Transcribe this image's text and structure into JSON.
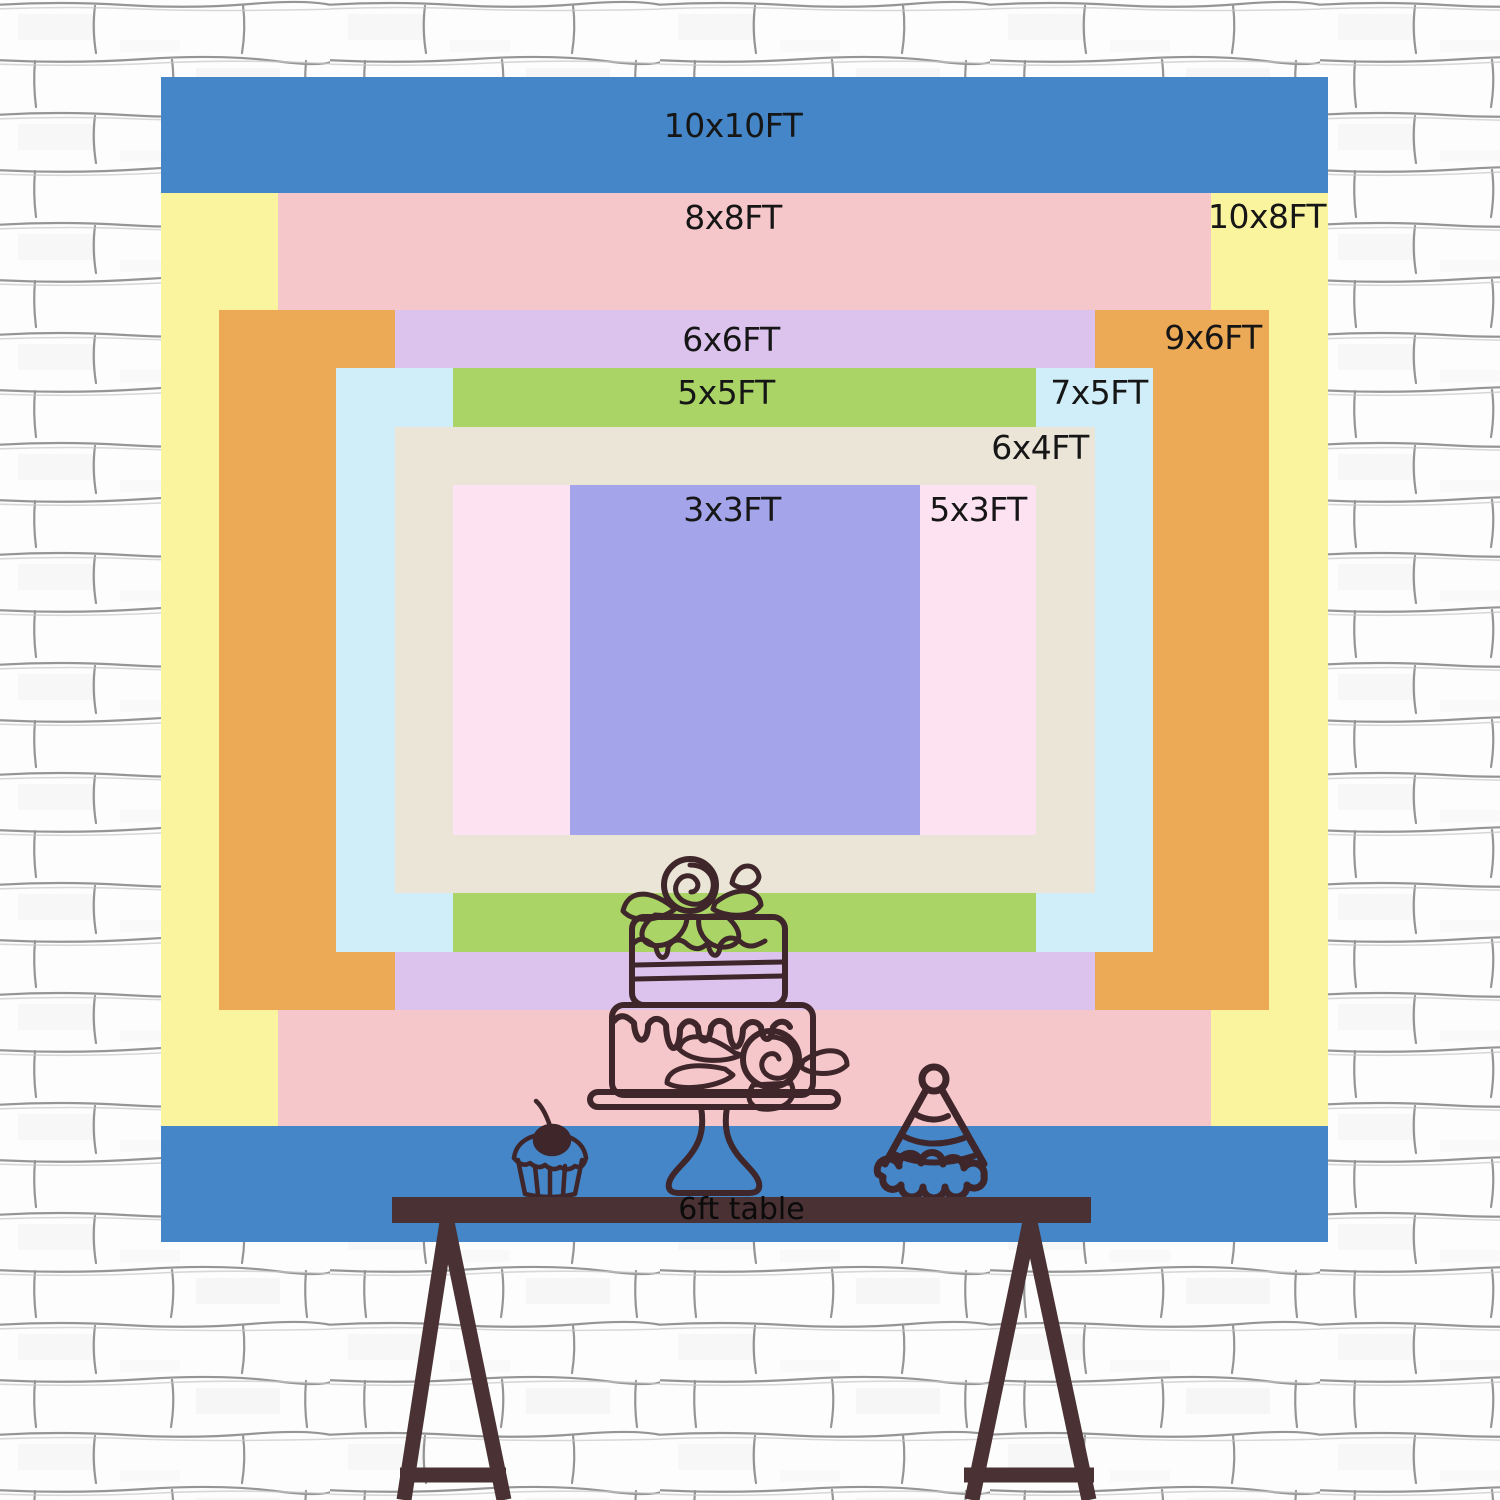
{
  "backdrop": {
    "description": "backdrop size comparison chart",
    "label_color": "#161616",
    "sizes": [
      {
        "id": "10x10ft",
        "label": "10x10FT",
        "color": "#4486c7"
      },
      {
        "id": "10x8ft",
        "label": "10x8FT",
        "color": "#fbf49e"
      },
      {
        "id": "8x8ft",
        "label": "8x8FT",
        "color": "#f5c7ca"
      },
      {
        "id": "9x6ft",
        "label": "9x6FT",
        "color": "#edaa56"
      },
      {
        "id": "6x6ft",
        "label": "6x6FT",
        "color": "#dcc3ee"
      },
      {
        "id": "7x5ft",
        "label": "7x5FT",
        "color": "#cfeef9"
      },
      {
        "id": "5x5ft",
        "label": "5x5FT",
        "color": "#aad566"
      },
      {
        "id": "6x4ft",
        "label": "6x4FT",
        "color": "#eae5d6"
      },
      {
        "id": "5x3ft",
        "label": "5x3FT",
        "color": "#fde3f1"
      },
      {
        "id": "3x3ft",
        "label": "3x3FT",
        "color": "#a3a4ea"
      }
    ]
  },
  "table": {
    "label": "6ft table",
    "color": "#4a3134",
    "text_color": "#0b0b0b"
  },
  "doodles": {
    "stroke_color": "#3f262a",
    "icons": [
      "cake-icon",
      "cupcake-icon",
      "party-hat-icon"
    ]
  },
  "wall": {
    "base_color": "#fdfdfd",
    "line_color": "#7a7a7a"
  }
}
